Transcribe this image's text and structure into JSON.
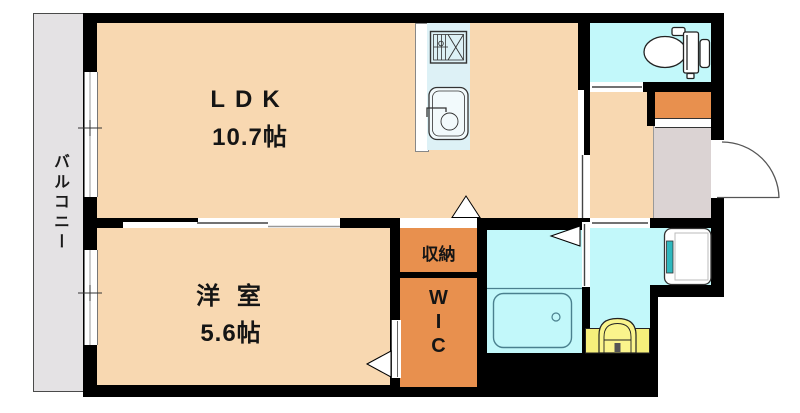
{
  "type": "floor-plan",
  "rooms": {
    "balcony": {
      "label": "バルコニー"
    },
    "ldk": {
      "label": "LDK",
      "size": "10.7帖"
    },
    "western_room": {
      "label": "洋 室",
      "size": "5.6帖"
    },
    "storage": {
      "label": "収納"
    },
    "wic": {
      "letters": [
        "W",
        "I",
        "C"
      ]
    }
  },
  "fixtures": [
    "gas-stove",
    "kitchen-sink",
    "refrigerator-space",
    "toilet",
    "entrance-door",
    "washing-machine-space",
    "bathtub",
    "washbasin"
  ],
  "colors": {
    "room_peach": "#F8D8B1",
    "closet_orange": "#E8904E",
    "wet_area_cyan": "#C2F8FA",
    "kitchen_cyan": "#DDF1F6",
    "balcony_gray": "#E4E2E4",
    "entrance_gray": "#DBD3D3",
    "basin_yellow": "#F6EF7B",
    "machine_teal": "#2FB8BE",
    "wall": "#000000"
  }
}
